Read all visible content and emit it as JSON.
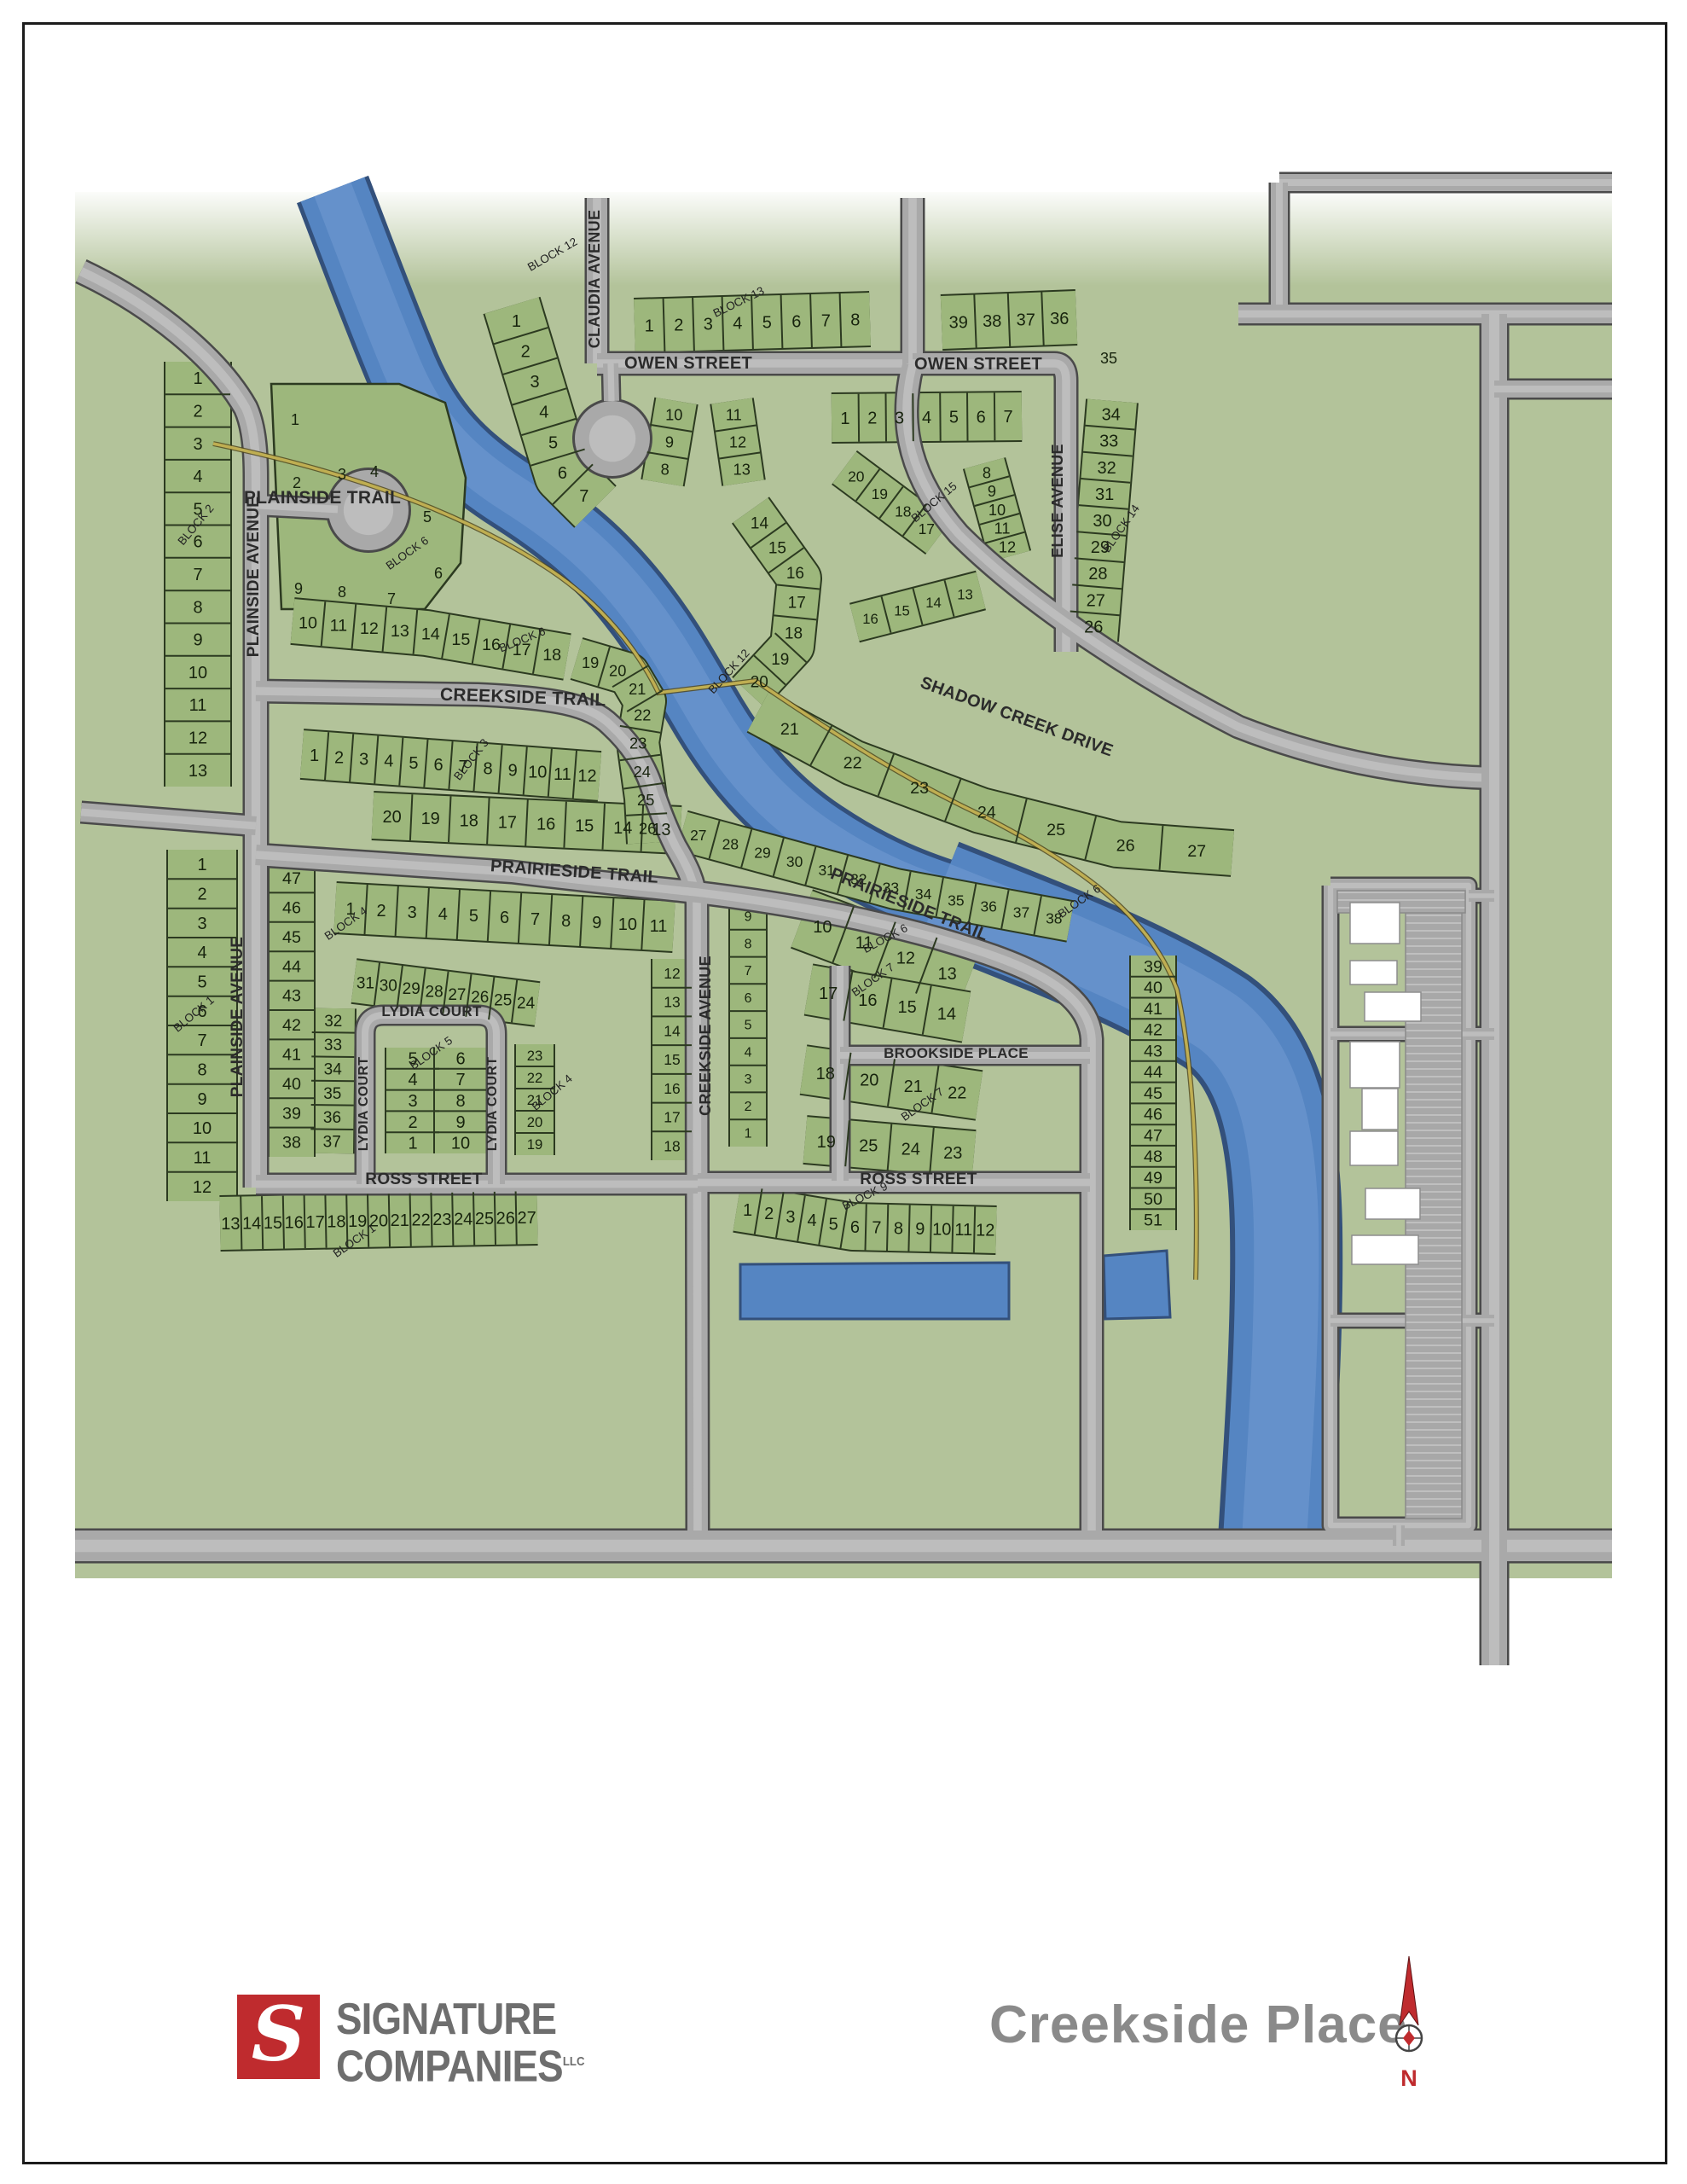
{
  "map_title": "Creekside Place",
  "developer": {
    "initial": "S",
    "name_line1": "SIGNATURE",
    "name_line2": "COMPANIES",
    "suffix": "LLC"
  },
  "north_label": "N",
  "streets": {
    "plainside_trail": "PLAINSIDE TRAIL",
    "plainside_avenue": "PLAINSIDE AVENUE",
    "claudia_avenue": "CLAUDIA AVENUE",
    "owen_street": "OWEN STREET",
    "elise_avenue": "ELISE AVENUE",
    "shadow_creek_drive": "SHADOW CREEK DRIVE",
    "creekside_trail": "CREEKSIDE TRAIL",
    "prairieside_trail": "PRAIRIESIDE TRAIL",
    "creekside_avenue": "CREEKSIDE AVENUE",
    "lydia_court": "LYDIA COURT",
    "brookside_place": "BROOKSIDE PLACE",
    "ross_street": "ROSS STREET"
  },
  "blocks": {
    "block1": {
      "label": "BLOCK 1",
      "strips": {
        "col": [
          1,
          2,
          3,
          4,
          5,
          6,
          7,
          8,
          9,
          10,
          11,
          12
        ],
        "row": [
          13,
          14,
          15,
          16,
          17,
          18,
          19,
          20,
          21,
          22,
          23,
          24,
          25,
          26,
          27
        ]
      }
    },
    "block2": {
      "label": "BLOCK 2",
      "strips": {
        "col": [
          1,
          2,
          3,
          4,
          5,
          6,
          7,
          8,
          9,
          10,
          11,
          12,
          13
        ]
      }
    },
    "block3": {
      "label": "BLOCK 3",
      "strips": {
        "north": [
          1,
          2,
          3,
          4,
          5,
          6,
          7,
          8,
          9,
          10,
          11,
          12
        ],
        "south": [
          20,
          19,
          18,
          17,
          16,
          15,
          14,
          13
        ]
      }
    },
    "block4": {
      "label": "BLOCK 4",
      "strips": {
        "top": [
          1,
          2,
          3,
          4,
          5,
          6,
          7,
          8,
          9,
          10,
          11
        ],
        "ecol": [
          12,
          13,
          14,
          15,
          16,
          17,
          18
        ],
        "ring": [
          31,
          30,
          29,
          28,
          27,
          26,
          25,
          24
        ],
        "icol": [
          23,
          22,
          21,
          20,
          19
        ],
        "diag": [
          32,
          33,
          34,
          35,
          36,
          37
        ],
        "wcol": [
          47,
          46,
          45,
          44,
          43,
          42,
          41,
          40,
          39,
          38
        ]
      }
    },
    "block5": {
      "label": "BLOCK 5",
      "strips": {
        "w": [
          5,
          4,
          3,
          2,
          1
        ],
        "e": [
          6,
          7,
          8,
          9,
          10
        ]
      }
    },
    "block6": {
      "label": "BLOCK 6",
      "singles": [
        1,
        2,
        3,
        4,
        5,
        6,
        7,
        8,
        9
      ],
      "strips": {
        "row": [
          10,
          11,
          12,
          13,
          14,
          15,
          16,
          17,
          18
        ],
        "arc": [
          19,
          20,
          21,
          22,
          23,
          24,
          25,
          26
        ],
        "diag": [
          27,
          28,
          29,
          30,
          31,
          32,
          33,
          34,
          35,
          36,
          37,
          38
        ],
        "scol": [
          39,
          40,
          41,
          42,
          43,
          44,
          45,
          46,
          47,
          48,
          49,
          50,
          51
        ]
      }
    },
    "block7": {
      "label": "BLOCK 7",
      "strips": {
        "wcol": [
          9,
          8,
          7,
          6,
          5,
          4,
          3,
          2,
          1
        ],
        "top": [
          10,
          11,
          12,
          13
        ],
        "r2": [
          17,
          16,
          15,
          14
        ],
        "r3": [
          18,
          20,
          21,
          22
        ],
        "r4": [
          19,
          25,
          24,
          23
        ]
      }
    },
    "block9": {
      "label": "BLOCK 9",
      "strips": {
        "row": [
          1,
          2,
          3,
          4,
          5,
          6,
          7,
          8,
          9,
          10,
          11,
          12
        ]
      }
    },
    "block12": {
      "label": "BLOCK 12",
      "strips": {
        "nw": [
          1,
          2,
          3,
          4,
          5,
          6,
          7
        ],
        "wb": [
          10,
          9,
          8
        ],
        "eb": [
          11,
          12,
          13
        ],
        "ck": [
          14,
          15,
          16,
          17,
          18,
          19,
          20
        ],
        "sh": [
          21,
          22,
          23,
          24,
          25,
          26,
          27
        ]
      }
    },
    "block13": {
      "label": "BLOCK 13",
      "strips": {
        "row": [
          1,
          2,
          3,
          4,
          5,
          6,
          7,
          8
        ]
      }
    },
    "block14": {
      "label": "BLOCK 14",
      "singles": [
        35
      ],
      "strips": {
        "row": [
          39,
          38,
          37,
          36
        ],
        "col": [
          34,
          33,
          32,
          31,
          30,
          29,
          28,
          27,
          26
        ]
      }
    },
    "block15": {
      "label": "BLOCK 15",
      "strips": {
        "row": [
          1,
          2,
          3,
          4,
          5,
          6,
          7
        ],
        "ec": [
          8,
          9,
          10,
          11,
          12
        ],
        "wa": [
          20,
          19,
          18,
          17
        ],
        "sa": [
          16,
          15,
          14,
          13
        ]
      }
    }
  },
  "colors": {
    "land": "#b3c39a",
    "lot": "#9db77c",
    "lot_edge": "#2c3a20",
    "road": "#a9a9a9",
    "road_casing": "#4a4a4a",
    "road_inner": "#c2c2c2",
    "water": "#5585c2",
    "water_edge": "#33507b",
    "water_light": "#6f98d0",
    "trail": "#bfae52",
    "number_text": "#17230d",
    "street_text": "#2b2b2b",
    "logo_red": "#bf2b2e",
    "logo_gray": "#6e6e6e",
    "title_gray": "#8a8a8a",
    "building": "#ffffff",
    "parking": "#a8a8a8"
  }
}
